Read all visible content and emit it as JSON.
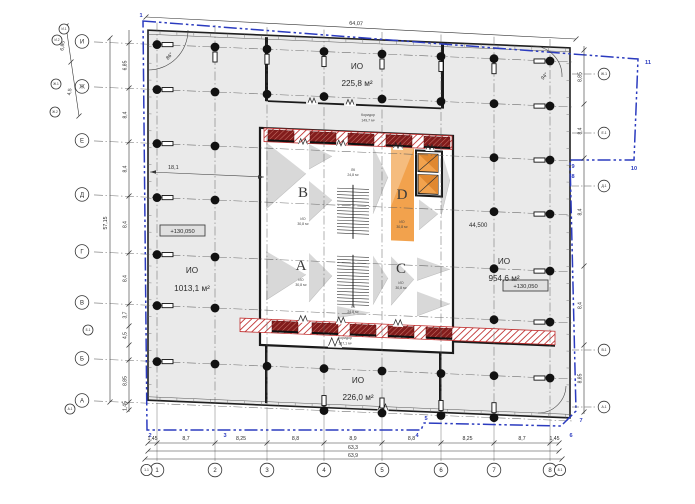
{
  "plan": {
    "halls": {
      "top": {
        "label": "ИО",
        "area": "225,8 м²"
      },
      "left": {
        "label": "ИО",
        "area": "1013,1 м²"
      },
      "right": {
        "label": "ИО",
        "area": "954,6 м²"
      },
      "bottom": {
        "label": "ИО",
        "area": "226,0 м²"
      }
    },
    "corridors": {
      "top": {
        "label": "Коридор",
        "area": "149,7 м²"
      },
      "bottom": {
        "label": "Коридор",
        "area": "137,1 м²"
      }
    },
    "zones": [
      {
        "label": "B",
        "area_line1": "ИО",
        "area_line2": "30,8 м²"
      },
      {
        "label": "D",
        "area_line1": "ИО",
        "area_line2": "30,8 м²"
      },
      {
        "label": "A",
        "area_line1": "ИО",
        "area_line2": "30,8 м²"
      },
      {
        "label": "C",
        "area_line1": "ИО",
        "area_line2": "30,8 м²"
      }
    ],
    "stairs": {
      "upper": {
        "label": "ЛК",
        "area": "24,8 м²"
      },
      "lower": {
        "label": "ЛК",
        "area": "24,8 м²"
      }
    },
    "levels": {
      "left": "+130,050",
      "right": "+130,050"
    },
    "annotations": {
      "elevation": "44,500",
      "inner_dim": "18,1",
      "angle_top_left": "86°",
      "angle_top_right": "94°"
    }
  },
  "axes": {
    "bottom": [
      "1",
      "2",
      "3",
      "4",
      "5",
      "6",
      "7",
      "8"
    ],
    "bottom_edge": [
      "1.1",
      "8.1"
    ],
    "left": [
      "И",
      "Ж",
      "Е",
      "Д",
      "Г",
      "В",
      "Б",
      "А"
    ],
    "left_secondary": [
      "И.1",
      "И.2",
      "Ж.1",
      "Ж.2",
      "Б.1",
      "А.1"
    ],
    "right": [
      "Ж.1",
      "Е.1",
      "Д.1",
      "В.1",
      "А.1"
    ]
  },
  "dimensions": {
    "top_total": "64,07",
    "bottom_segments": [
      "1,45",
      "8,7",
      "8,25",
      "8,8",
      "8,9",
      "8,8",
      "8,25",
      "8,7",
      "1,45"
    ],
    "bottom_total_inner": "63,3",
    "bottom_total_outer": "63,9",
    "left_total": "57,15",
    "left_segments": [
      "6,85",
      "8,4",
      "8,4",
      "8,4",
      "8,4",
      "3,7",
      "4,5",
      "",
      "8,85",
      "1,45"
    ],
    "left_outer": [
      "6,85",
      "4,5"
    ],
    "right_segments": [
      "8,85",
      "8,4",
      "8,4",
      "8,4",
      "8,85"
    ]
  },
  "site_boundary": {
    "vertex_labels": [
      "1",
      "2",
      "3",
      "4",
      "5",
      "6",
      "7",
      "8",
      "9",
      "10",
      "11"
    ]
  },
  "colors": {
    "slab": "#eaeaea",
    "wall": "#1a1a1a",
    "hatch_red": "#c03030",
    "pier_red": "#821c1c",
    "highlight_orange": "#f2a24d",
    "boundary_blue": "#2b3bbf",
    "shade": "#d6d6d6",
    "dim": "#333333"
  }
}
